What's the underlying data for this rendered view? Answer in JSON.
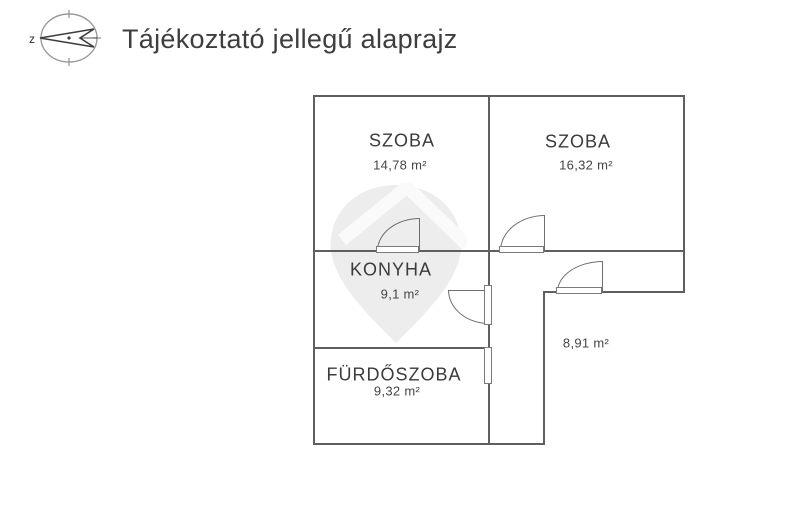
{
  "header": {
    "title": "Tájékoztató jellegű alaprajz",
    "compass_label": "z"
  },
  "floorplan": {
    "rooms": [
      {
        "name": "SZOBA",
        "area": "14,78 m²"
      },
      {
        "name": "SZOBA",
        "area": "16,32 m²"
      },
      {
        "name": "KONYHA",
        "area": "9,1 m²"
      },
      {
        "name": "FÜRDŐSZOBA",
        "area": "9,32 m²"
      },
      {
        "name": "",
        "area": "8,91 m²"
      }
    ]
  },
  "colors": {
    "wall": "#5f5f5f",
    "text": "#3b3b3b",
    "watermark": "#ededed",
    "background": "#ffffff"
  }
}
